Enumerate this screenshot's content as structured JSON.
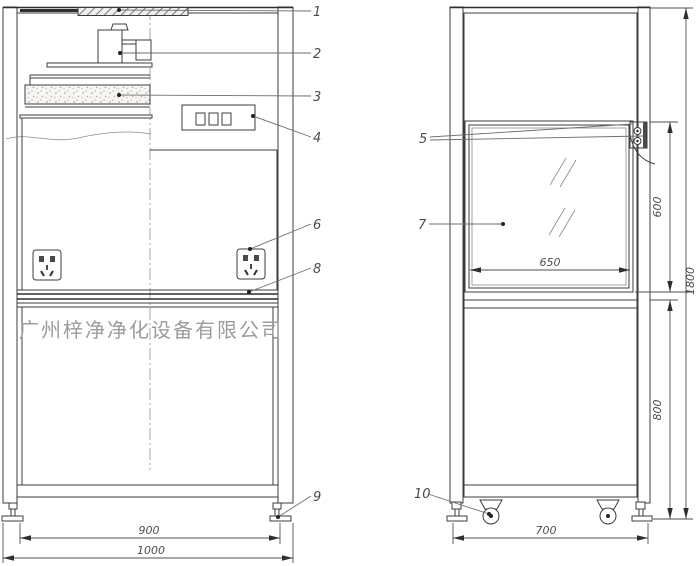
{
  "watermark": {
    "text": "广州梓净净化设备有限公司"
  },
  "callouts": {
    "c1": "1",
    "c2": "2",
    "c3": "3",
    "c4": "4",
    "c5": "5",
    "c6": "6",
    "c7": "7",
    "c8": "8",
    "c9": "9",
    "c10": "10"
  },
  "dimensions": {
    "inner_width": "900",
    "outer_width": "1000",
    "sash_width": "650",
    "window_height": "600",
    "overall_height": "1800",
    "lower_height": "800",
    "depth": "700"
  }
}
